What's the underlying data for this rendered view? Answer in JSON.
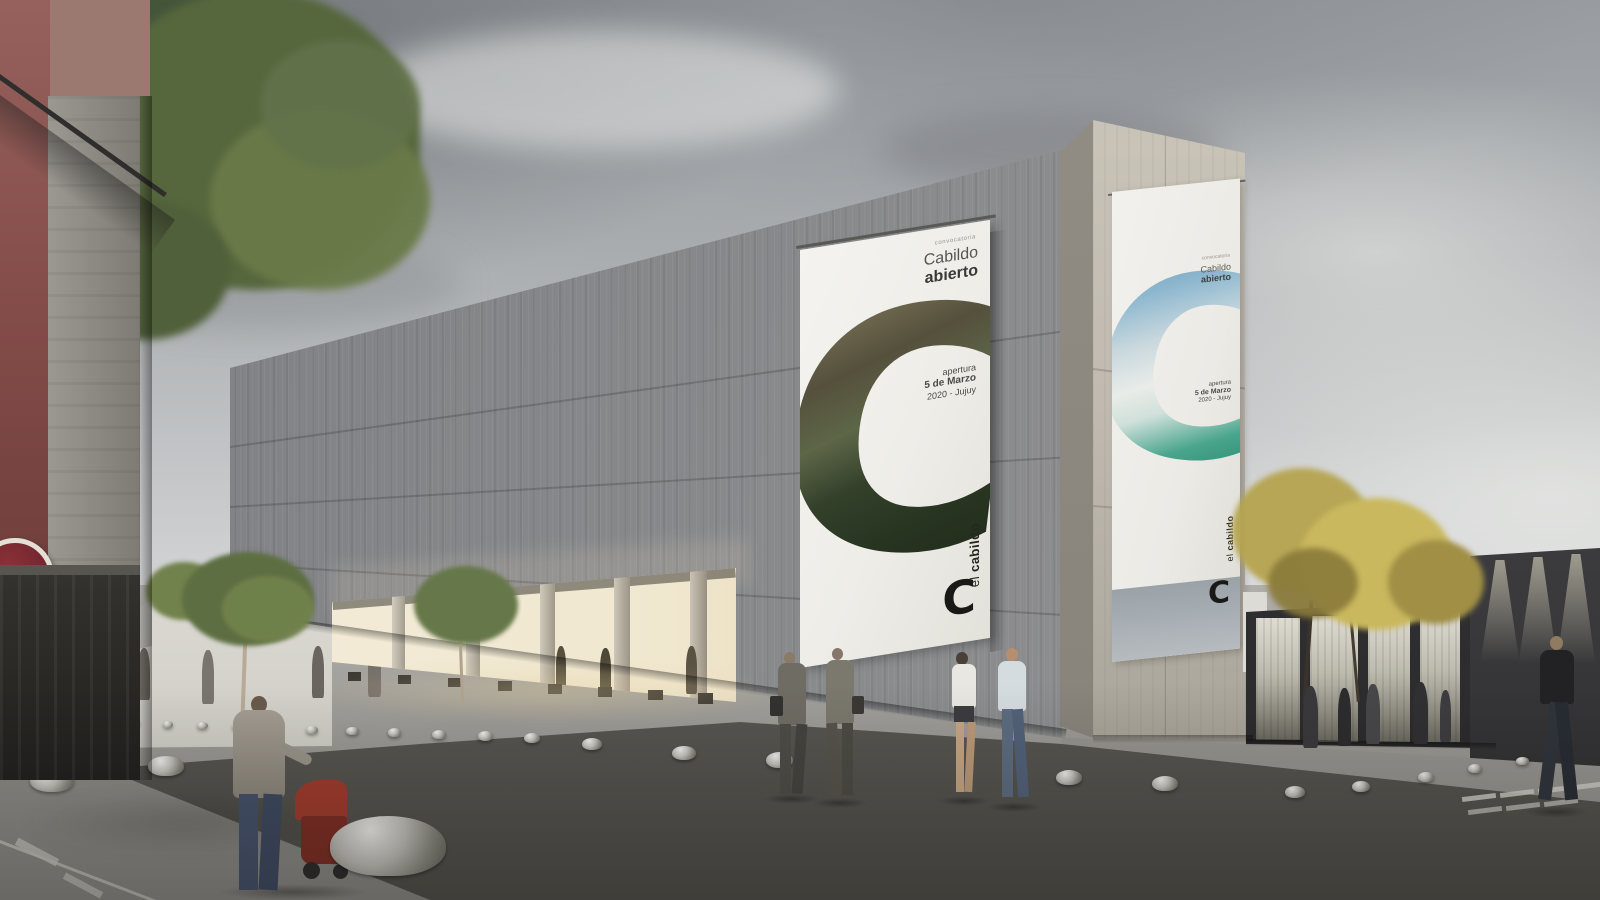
{
  "scene": {
    "title": "El Cabildo cultural centre - overcast street rendering",
    "palette": {
      "sky_grey": "#b3b6b8",
      "concrete_facade": "#85878a",
      "tower_beige": "#c2bcb0",
      "banner_white": "#f2f1ec",
      "photo_rock": "#8a8168",
      "photo_green": "#2e3b26",
      "photo_sky_blue": "#6f9fbd",
      "photo_teal": "#3a9b82",
      "logo_black": "#1d1c1a",
      "accent_red": "#a23a2c",
      "asphalt": "#6b6a66",
      "warm_interior": "#f0e6cc"
    }
  },
  "banner": {
    "tagline": "convocatoria",
    "title_line1": "Cabildo",
    "title_line2": "abierto",
    "event_line1": "apertura",
    "event_line2": "5 de Marzo",
    "event_line3": "2020 - Jujuy",
    "brand_el": "el",
    "brand_name": "cabildo",
    "brand_letter": "C",
    "big_letter": "C"
  }
}
